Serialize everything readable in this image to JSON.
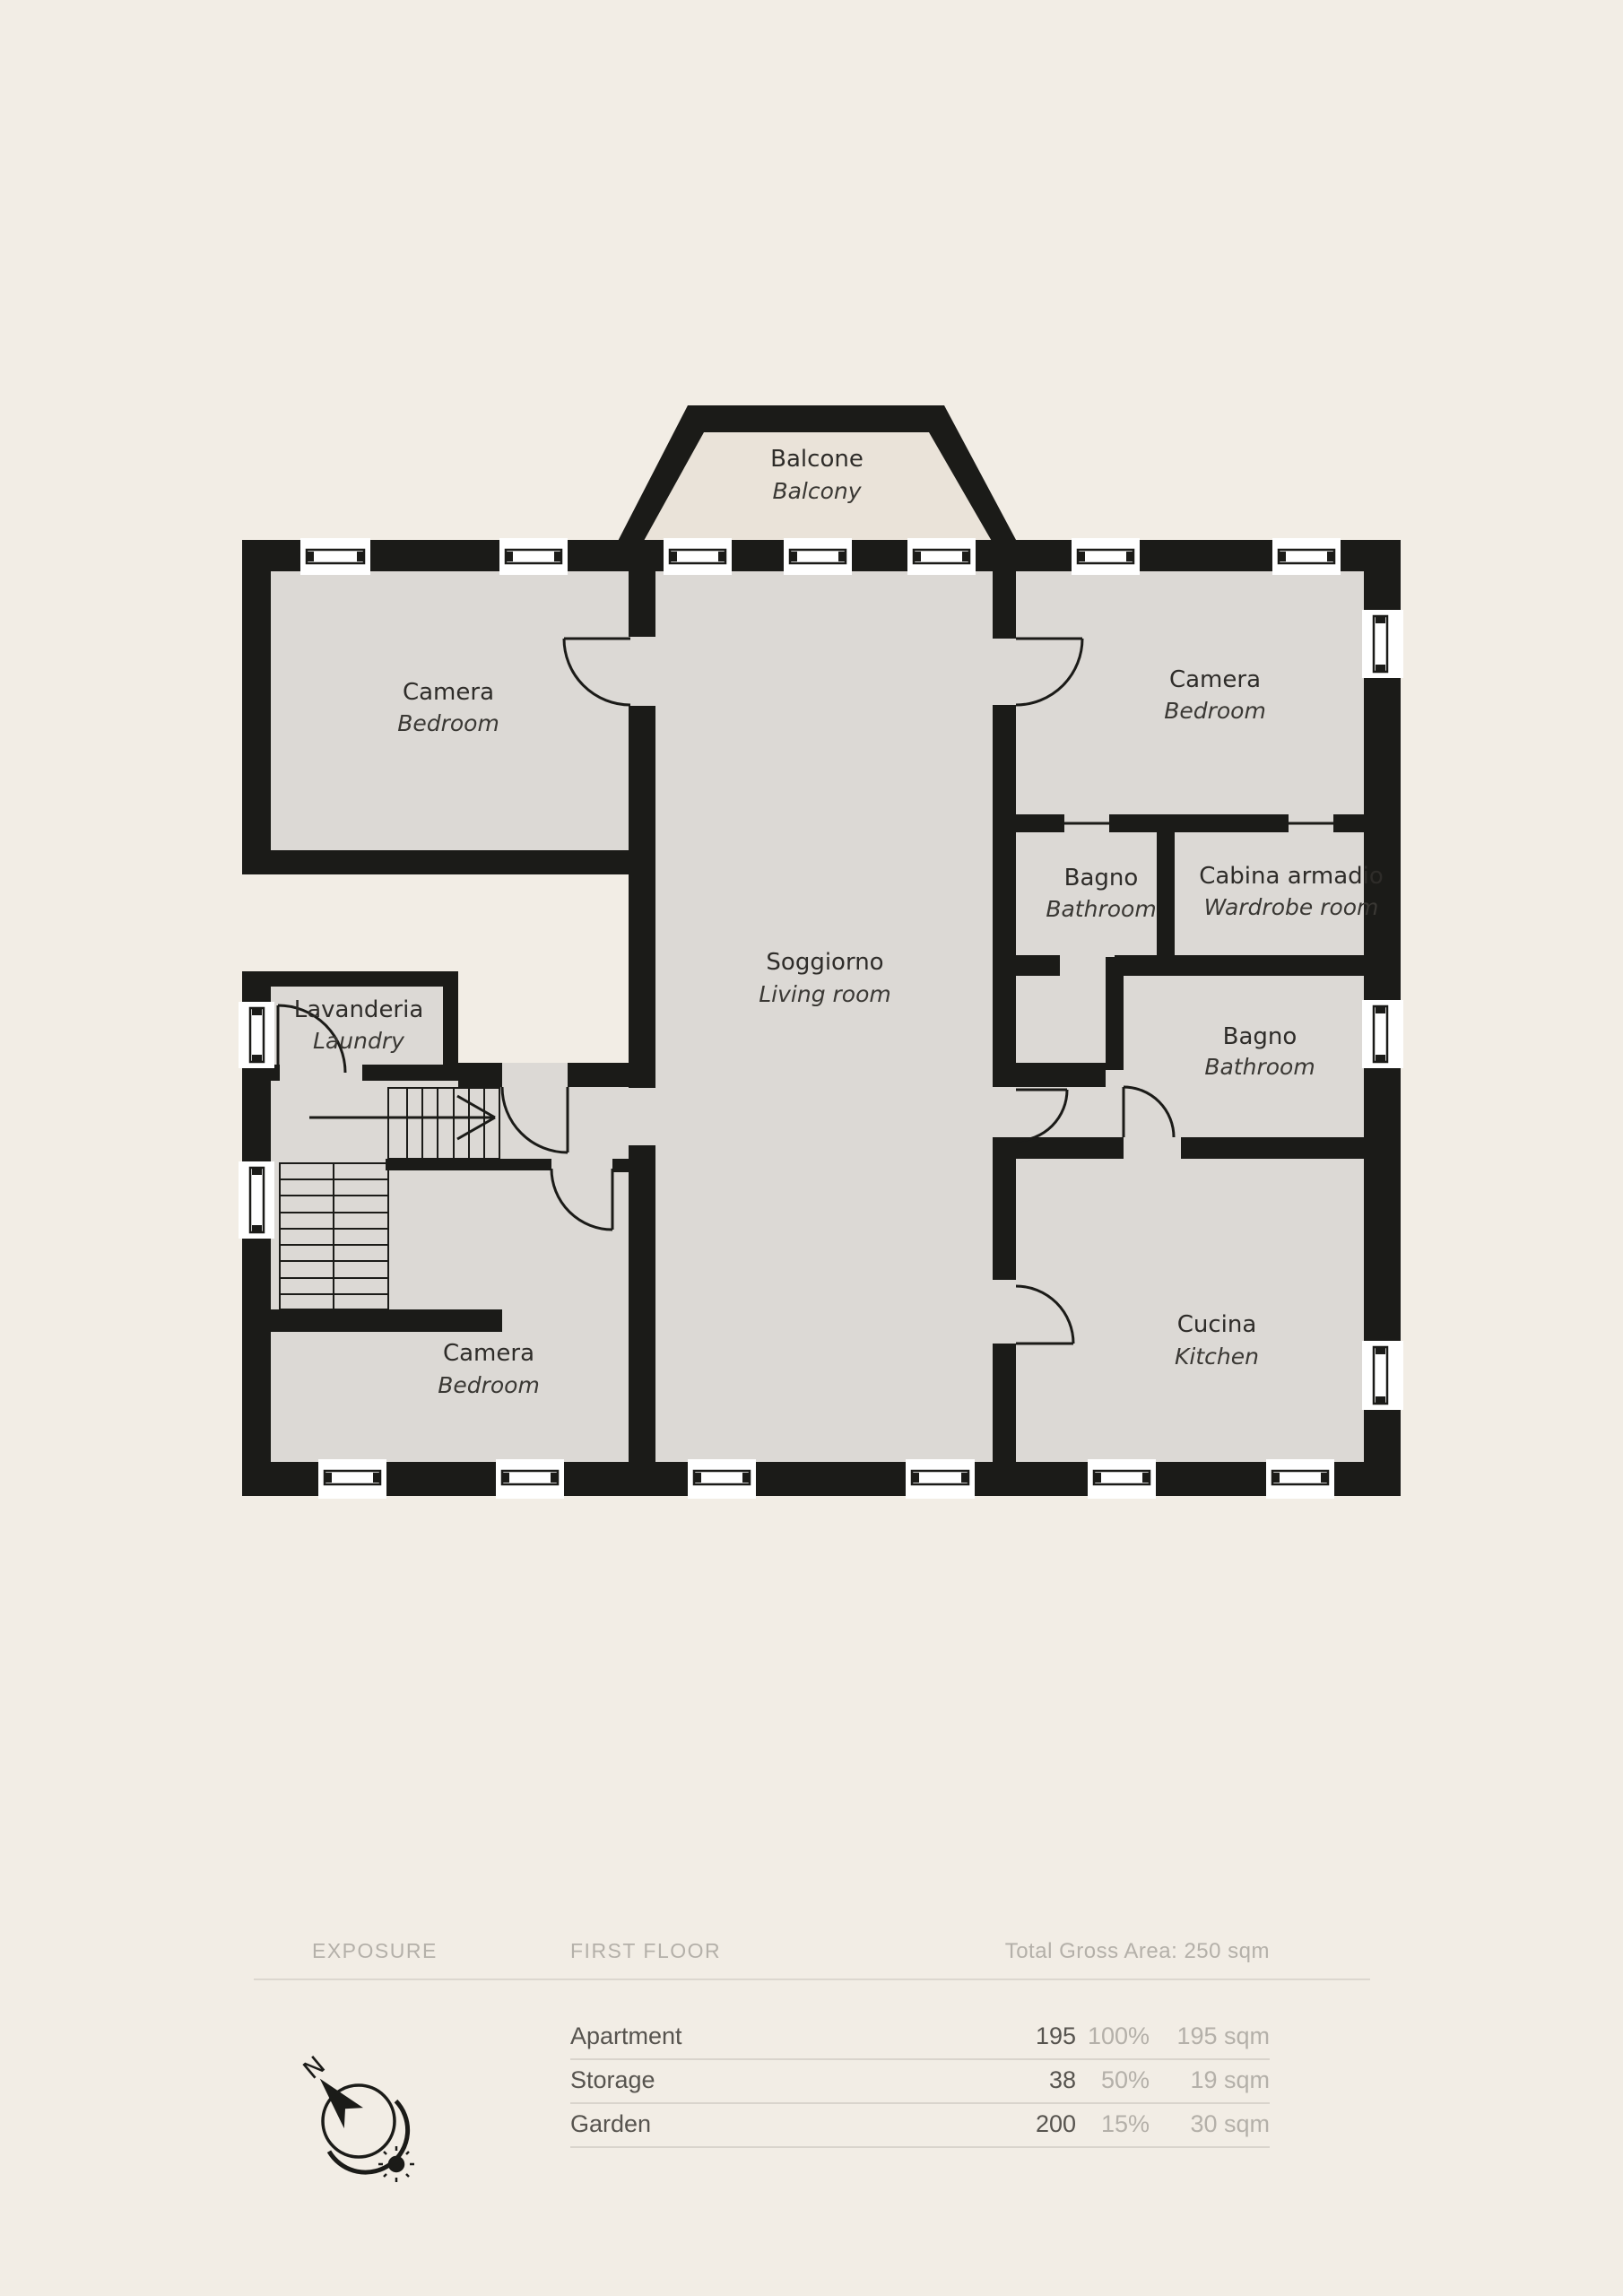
{
  "plan": {
    "rooms": [
      {
        "id": "balcony",
        "it": "Balcone",
        "en": "Balcony"
      },
      {
        "id": "bedroom-nw",
        "it": "Camera",
        "en": "Bedroom"
      },
      {
        "id": "bedroom-ne",
        "it": "Camera",
        "en": "Bedroom"
      },
      {
        "id": "bathroom-top",
        "it": "Bagno",
        "en": "Bathroom"
      },
      {
        "id": "wardrobe-room",
        "it": "Cabina armadio",
        "en": "Wardrobe room"
      },
      {
        "id": "living-room",
        "it": "Soggiorno",
        "en": "Living room"
      },
      {
        "id": "bathroom-right",
        "it": "Bagno",
        "en": "Bathroom"
      },
      {
        "id": "laundry",
        "it": "Lavanderia",
        "en": "Laundry"
      },
      {
        "id": "bedroom-sw",
        "it": "Camera",
        "en": "Bedroom"
      },
      {
        "id": "kitchen",
        "it": "Cucina",
        "en": "Kitchen"
      }
    ],
    "compass_north_label": "N"
  },
  "legend": {
    "exposure_label": "EXPOSURE",
    "floor_label": "FIRST FLOOR",
    "total_label": "Total Gross Area: 250 sqm",
    "rows": [
      {
        "name": "Apartment",
        "value": "195",
        "percent": "100%",
        "area": "195 sqm"
      },
      {
        "name": "Storage",
        "value": "38",
        "percent": "50%",
        "area": "19 sqm"
      },
      {
        "name": "Garden",
        "value": "200",
        "percent": "15%",
        "area": "30 sqm"
      }
    ]
  },
  "colors": {
    "background": "#f2ede5",
    "floor": "#dcd9d5",
    "balcony_floor": "#eae3d9",
    "walls": "#1b1b18",
    "legend_muted": "#b4b0a9",
    "legend_dark": "#57544f"
  }
}
